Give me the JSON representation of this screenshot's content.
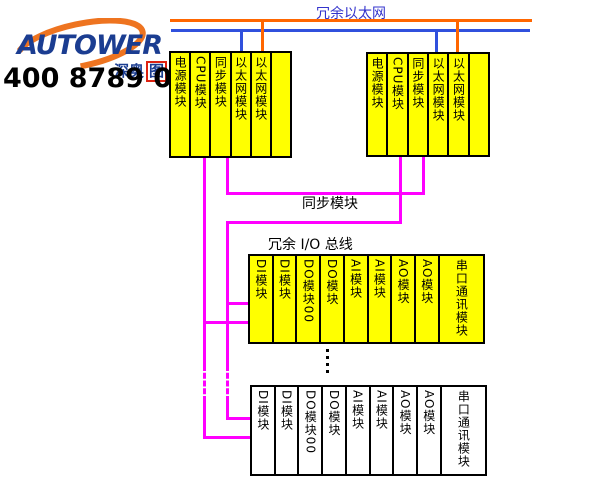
{
  "colors": {
    "yellow": "#ffff00",
    "magenta": "#ff00ff",
    "orange": "#ff6600",
    "eth_blue": "#3050dd",
    "label_blue": "#3333cc",
    "navy": "#1b3d91",
    "logo_orange": "#ee7420",
    "seal_red": "#dd2211",
    "line_black": "#000000"
  },
  "branding": {
    "logo_text": "AUTOWER",
    "logo_sub": "深奥",
    "logo_seal": "图",
    "phone": "400 8789 055"
  },
  "labels": {
    "ethernet": "冗余以太网",
    "sync": "同步模块",
    "io_bus": "冗余 I/O 总线"
  },
  "controller_racks": [
    {
      "modules": [
        "电源模块",
        "CPU模块",
        "同步模块",
        "以太网模块",
        "以太网模块",
        ""
      ]
    },
    {
      "modules": [
        "电源模块",
        "CPU模块",
        "同步模块",
        "以太网模块",
        "以太网模块",
        ""
      ]
    }
  ],
  "io_racks": [
    {
      "modules": [
        {
          "label": "DI模块"
        },
        {
          "label": "DI模块"
        },
        {
          "label": "DO模块00"
        },
        {
          "label": "DO模块"
        },
        {
          "label": "AI模块"
        },
        {
          "label": "AI模块"
        },
        {
          "label": "AO模块"
        },
        {
          "label": "AO模块"
        },
        {
          "label": "串口通讯模块",
          "wide": true
        }
      ]
    },
    {
      "modules": [
        {
          "label": "DI模块"
        },
        {
          "label": "DI模块"
        },
        {
          "label": "DO模块00"
        },
        {
          "label": "DO模块"
        },
        {
          "label": "AI模块"
        },
        {
          "label": "AI模块"
        },
        {
          "label": "AO模块"
        },
        {
          "label": "AO模块"
        },
        {
          "label": "串口通讯模块",
          "wide": true
        }
      ]
    }
  ]
}
